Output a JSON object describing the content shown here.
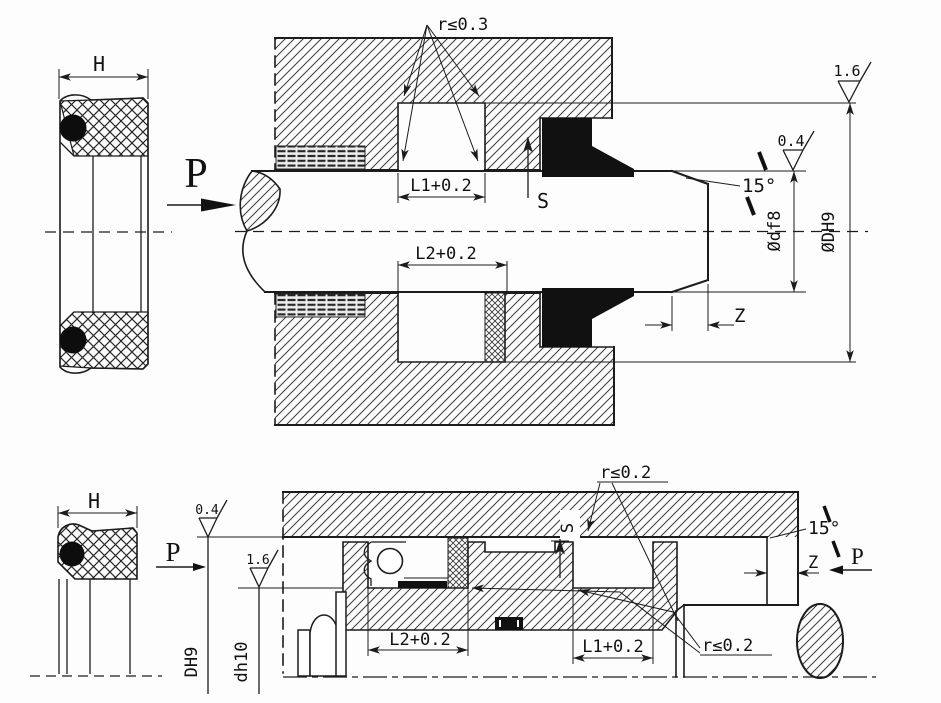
{
  "drawing": {
    "ink": "#1c1c1c",
    "paper": "#fdfdfd"
  },
  "top": {
    "h": "H",
    "p": "P",
    "r_note": "r≤0.3",
    "l1": "L1+0.2",
    "l2": "L2+0.2",
    "s": "S",
    "angle": "15°",
    "z": "Z",
    "rod_dia": "Ødf8",
    "bore_dia": "ØDH9",
    "ra_rod": "0.4",
    "ra_bore": "1.6"
  },
  "bottom": {
    "h": "H",
    "p_left": "P",
    "p_right": "P",
    "r_note_top": "r≤0.2",
    "r_note_bottom": "r≤0.2",
    "l1": "L1+0.2",
    "l2": "L2+0.2",
    "s": "S",
    "angle": "15°",
    "z": "Z",
    "bore_dia": "DH9",
    "groove_dia": "dh10",
    "ra_bore": "0.4",
    "ra_groove": "1.6"
  }
}
